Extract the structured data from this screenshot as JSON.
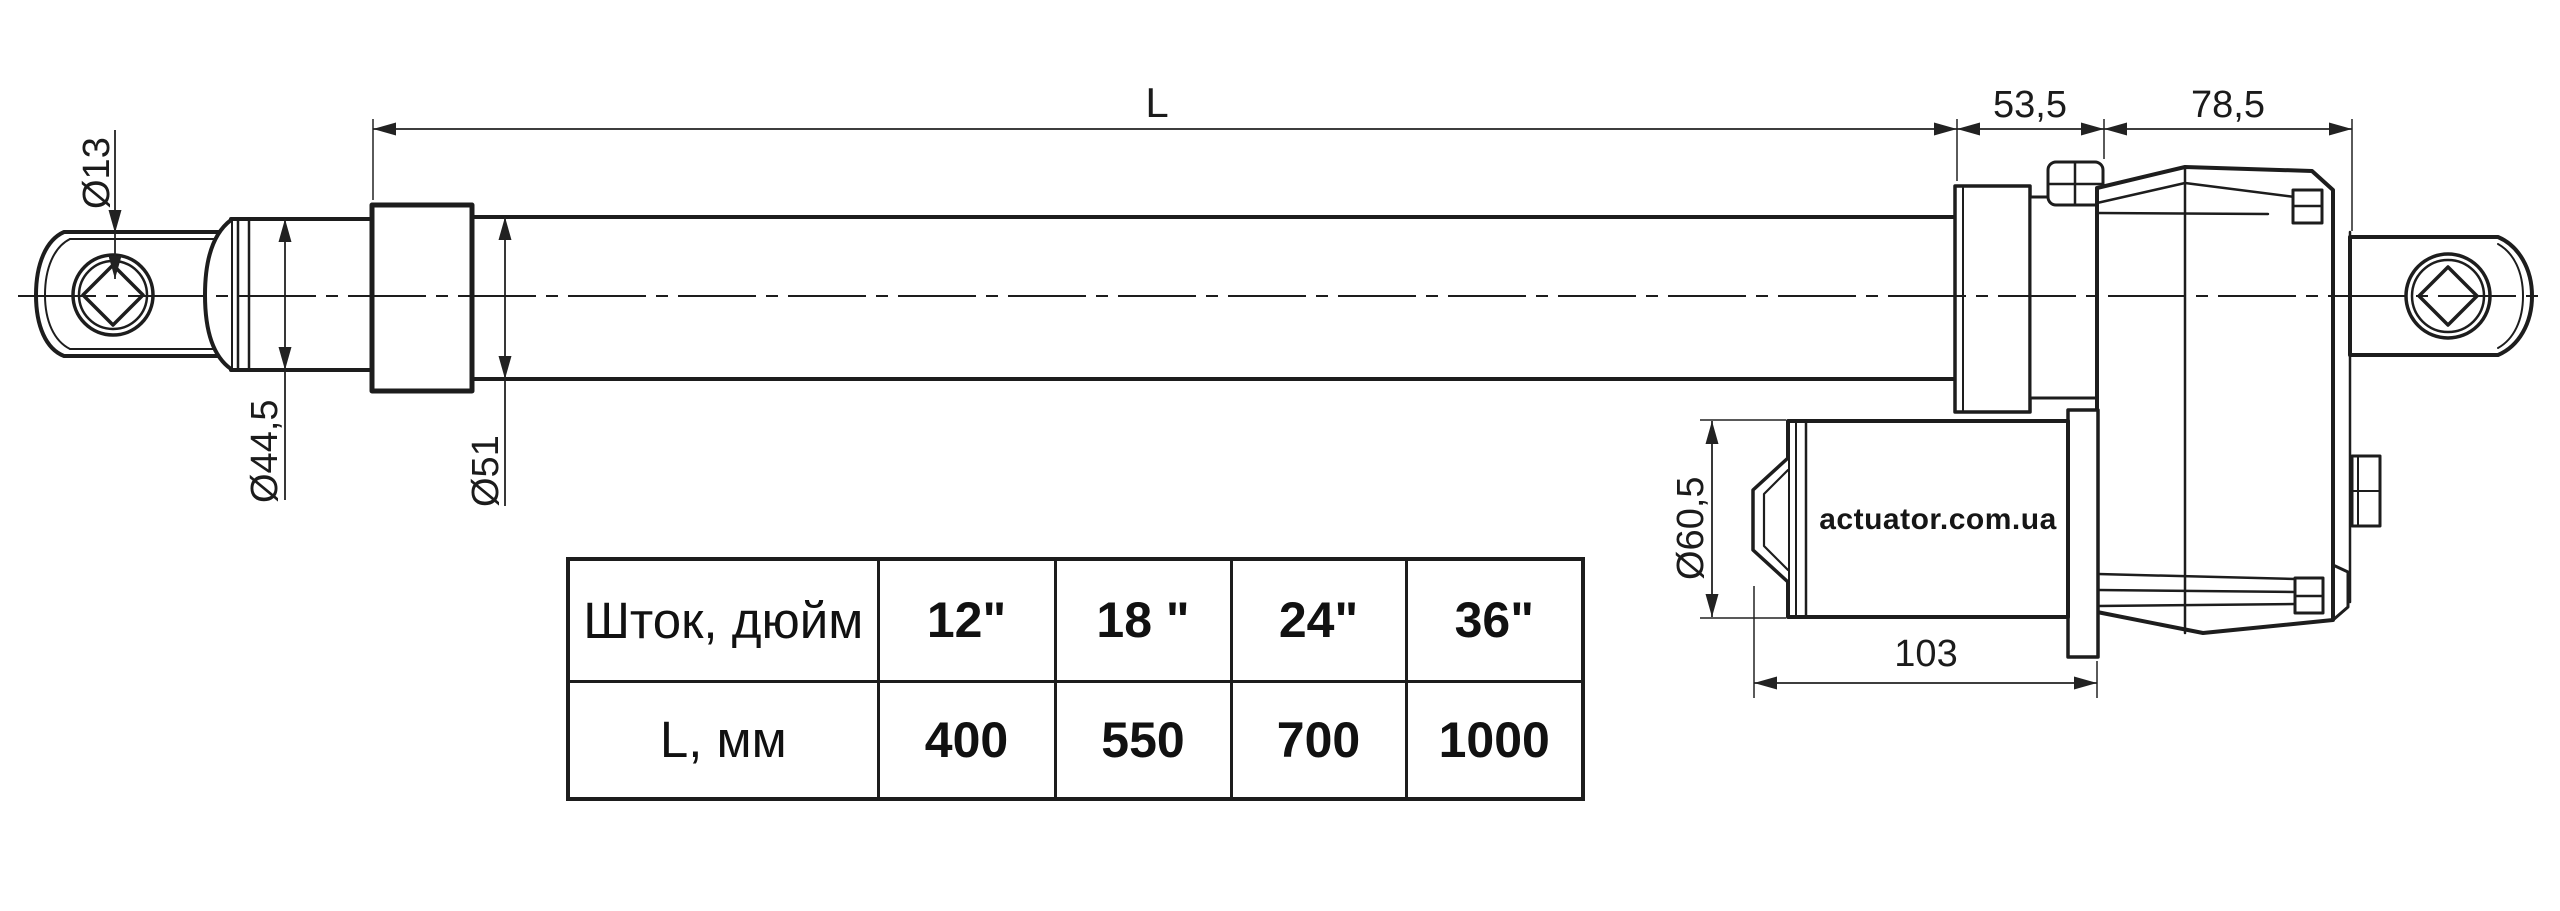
{
  "labels": {
    "dim_total_length": "L",
    "dim_gear_offset": "53,5",
    "dim_gear_length": "78,5",
    "dim_eye_hole": "Ø13",
    "dim_front_cap_diameter": "Ø44,5",
    "dim_tube_diameter": "Ø51",
    "dim_motor_diameter": "Ø60,5",
    "dim_motor_length": "103",
    "watermark": "actuator.com.ua"
  },
  "table": {
    "rows": [
      {
        "label": "Шток, дюйм",
        "values": [
          "12\"",
          "18 \"",
          "24\"",
          "36\""
        ]
      },
      {
        "label": "L, мм",
        "values": [
          "400",
          "550",
          "700",
          "1000"
        ]
      }
    ]
  },
  "colors": {
    "line": "#1d1d1d",
    "background": "#ffffff",
    "watermark": "#161616"
  }
}
